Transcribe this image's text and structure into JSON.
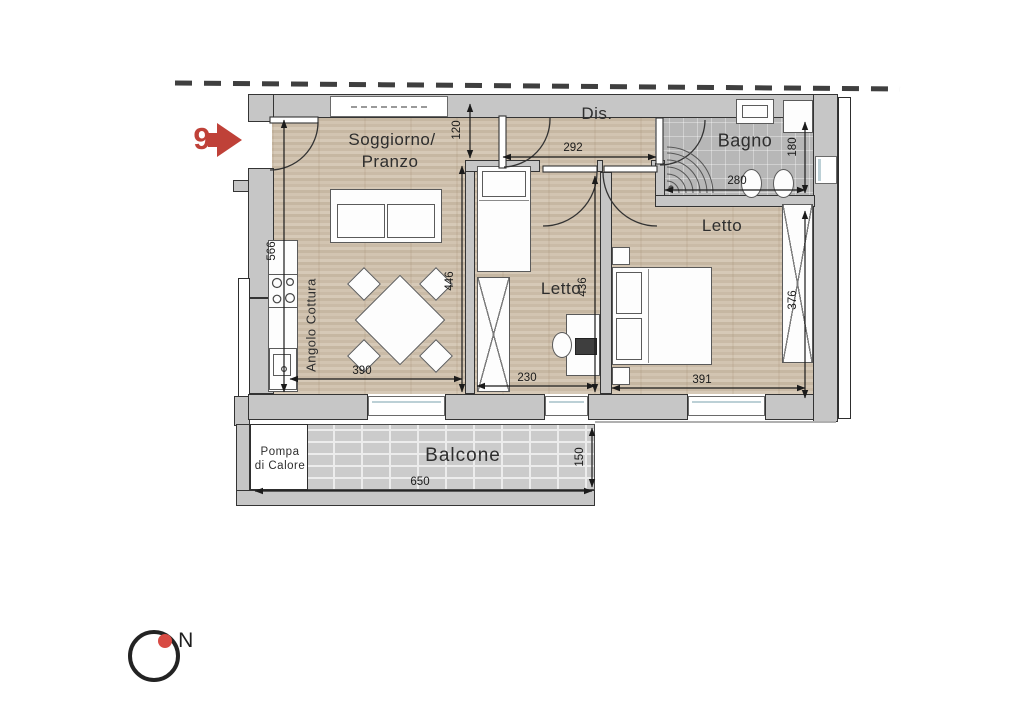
{
  "plan": {
    "unit": {
      "number": "9"
    },
    "rooms": {
      "soggiorno_line1": "Soggiorno/",
      "soggiorno_line2": "Pranzo",
      "dis": "Dis.",
      "bagno": "Bagno",
      "letto_mid": "Letto",
      "letto_right": "Letto",
      "angolo_cottura": "Angolo Cottura",
      "balcone": "Balcone",
      "pompa_line1": "Pompa",
      "pompa_line2": "di Calore"
    },
    "dimensions": {
      "passage_soggiorno_dis": "120",
      "dis_width": "292",
      "bagno_depth": "180",
      "bagno_width": "280",
      "soggiorno_depth": "566",
      "soggiorno_right_depth": "446",
      "letto_mid_depth": "436",
      "letto_mid_width": "230",
      "soggiorno_width": "390",
      "letto_right_width": "391",
      "letto_right_depth": "376",
      "balcone_depth": "150",
      "balcone_width": "650"
    },
    "compass": {
      "north": "N"
    },
    "colors": {
      "accent_red": "#bf4138",
      "wall_gray": "#c6c6c6",
      "wood_floor": "#d4c7b5",
      "tile_gray": "#b7b7b7"
    }
  }
}
